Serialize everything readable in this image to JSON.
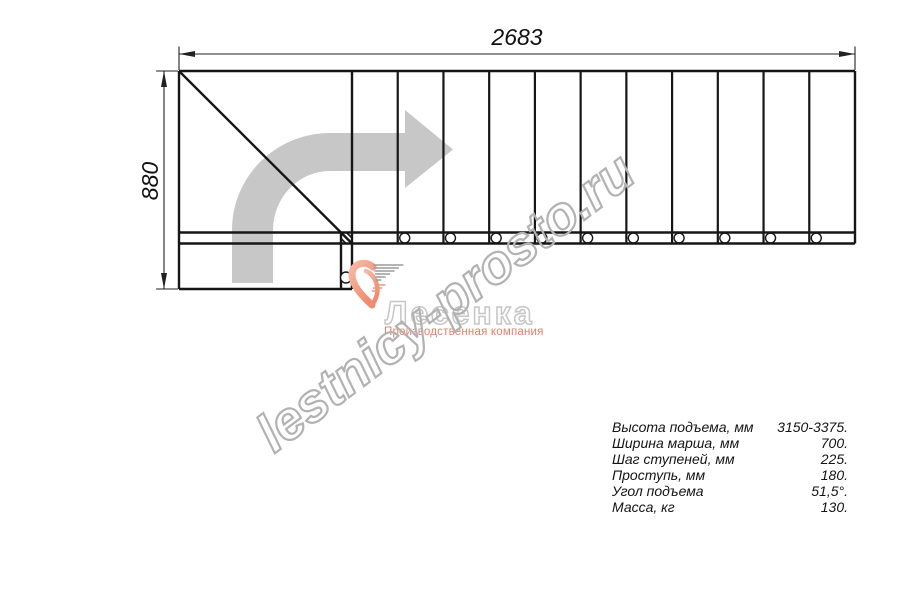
{
  "drawing": {
    "top_dimension": "2683",
    "left_dimension": "880",
    "straight_steps": 11,
    "direction_arrow": "turn-right-ascending"
  },
  "watermark": "lestnicy-prosto.ru",
  "logo": {
    "name": "Лесенка",
    "tagline": "Производственная компания"
  },
  "specs": [
    {
      "label": "Высота подъема, мм",
      "value": "3150-3375."
    },
    {
      "label": "Ширина марша, мм",
      "value": "700."
    },
    {
      "label": "Шаг ступеней, мм",
      "value": "225."
    },
    {
      "label": "Проступь, мм",
      "value": "180."
    },
    {
      "label": "Угол подъема",
      "value": "51,5°."
    },
    {
      "label": "Масса, кг",
      "value": "130."
    }
  ],
  "colors": {
    "line": "#161616",
    "dimension": "#222222",
    "direction_arrow": "#c7c7c7",
    "watermark": "#b2b2b2",
    "brand_salmon": "#ee8a6e",
    "logo_gray": "#c6c6c6"
  }
}
